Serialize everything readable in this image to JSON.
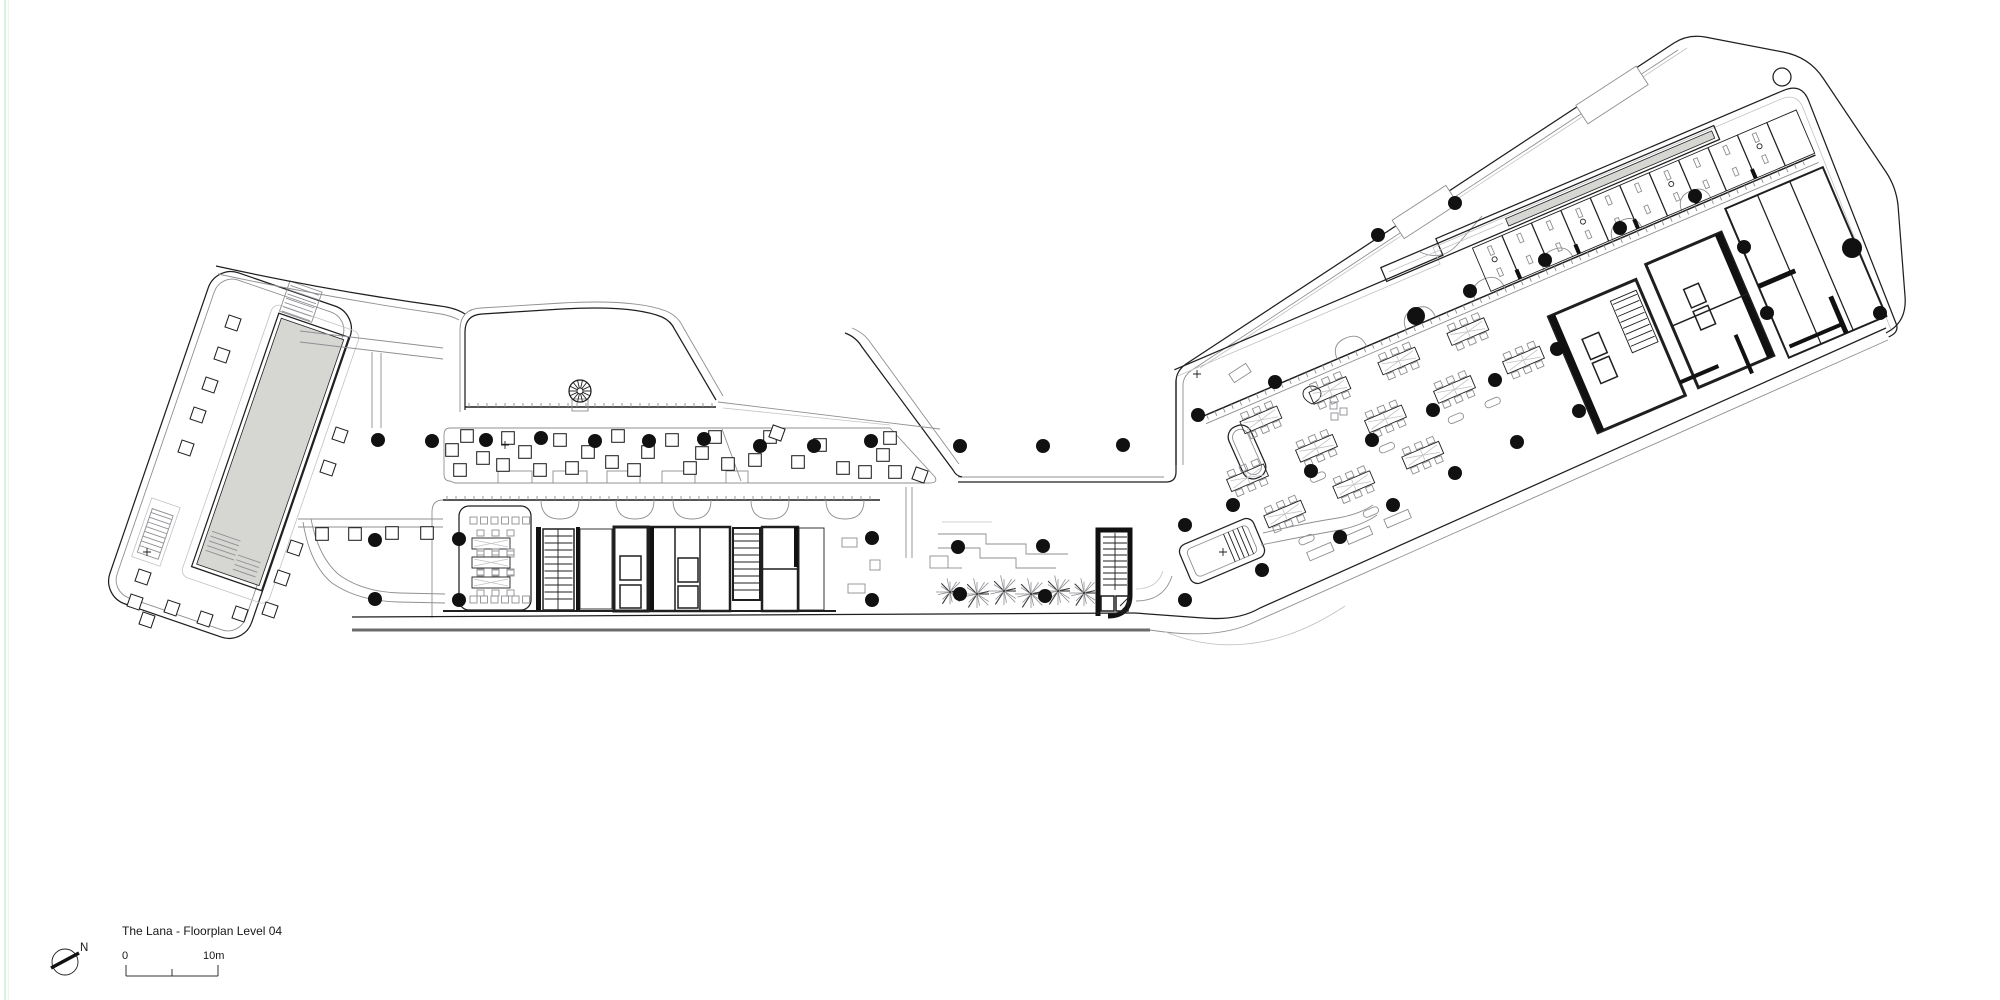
{
  "legend": {
    "title": "The Lana - Floorplan Level 04",
    "scale_zero": "0",
    "scale_end": "10m",
    "north_label": "N"
  },
  "colors": {
    "paper": "#ffffff",
    "ink": "#1f1f1f",
    "light": "#8f8f94",
    "faint": "#c2c2c6",
    "wall": "#111111",
    "pool": "#d6d6d2",
    "deck": "#6b6b6b",
    "sheet_edge": "#d4efd4"
  },
  "plan": {
    "columns": [
      [
        378,
        440
      ],
      [
        432,
        441
      ],
      [
        486,
        440
      ],
      [
        541,
        438
      ],
      [
        595,
        441
      ],
      [
        649,
        441
      ],
      [
        704,
        439
      ],
      [
        760,
        446
      ],
      [
        814,
        446
      ],
      [
        871,
        441
      ],
      [
        375,
        540
      ],
      [
        375,
        599
      ],
      [
        459,
        539
      ],
      [
        459,
        600
      ],
      [
        872,
        538
      ],
      [
        872,
        600
      ],
      [
        960,
        446
      ],
      [
        1043,
        446
      ],
      [
        1123,
        445
      ],
      [
        958,
        547
      ],
      [
        1043,
        546
      ],
      [
        960,
        594
      ],
      [
        1045,
        596
      ],
      [
        1198,
        415
      ],
      [
        1275,
        382
      ],
      [
        1233,
        505
      ],
      [
        1185,
        525
      ],
      [
        1262,
        570
      ],
      [
        1185,
        600
      ],
      [
        1340,
        537
      ],
      [
        1311,
        471
      ],
      [
        1378,
        235
      ],
      [
        1455,
        203
      ],
      [
        1416,
        316,
        9
      ],
      [
        1470,
        291
      ],
      [
        1545,
        260
      ],
      [
        1620,
        228
      ],
      [
        1695,
        196
      ],
      [
        1744,
        247
      ],
      [
        1372,
        440
      ],
      [
        1433,
        410
      ],
      [
        1495,
        380
      ],
      [
        1557,
        349
      ],
      [
        1393,
        505
      ],
      [
        1455,
        473
      ],
      [
        1517,
        442
      ],
      [
        1579,
        411
      ],
      [
        1852,
        248,
        10
      ],
      [
        1880,
        313
      ],
      [
        1767,
        313
      ]
    ],
    "planter_squares": [
      [
        233,
        323,
        19
      ],
      [
        222,
        355,
        19
      ],
      [
        210,
        385,
        19
      ],
      [
        198,
        415,
        19
      ],
      [
        186,
        448,
        19
      ],
      [
        143,
        577,
        19
      ],
      [
        135,
        602,
        19
      ],
      [
        147,
        620,
        19
      ],
      [
        172,
        608,
        19
      ],
      [
        205,
        619,
        19
      ],
      [
        240,
        614,
        19
      ],
      [
        270,
        610,
        19
      ],
      [
        282,
        578,
        19
      ],
      [
        295,
        548,
        19
      ],
      [
        328,
        468,
        19
      ],
      [
        340,
        435,
        19
      ],
      [
        322,
        534,
        0
      ],
      [
        355,
        534,
        0
      ],
      [
        392,
        533,
        0
      ],
      [
        427,
        533,
        0
      ],
      [
        452,
        450,
        0
      ],
      [
        467,
        436,
        0
      ],
      [
        460,
        470,
        0
      ],
      [
        483,
        458,
        0
      ],
      [
        508,
        438,
        0
      ],
      [
        503,
        465,
        0
      ],
      [
        525,
        452,
        0
      ],
      [
        540,
        470,
        0
      ],
      [
        560,
        440,
        0
      ],
      [
        572,
        468,
        0
      ],
      [
        588,
        452,
        0
      ],
      [
        618,
        436,
        0
      ],
      [
        612,
        462,
        0
      ],
      [
        634,
        470,
        0
      ],
      [
        648,
        452,
        0
      ],
      [
        672,
        440,
        0
      ],
      [
        690,
        468,
        0
      ],
      [
        702,
        453,
        0
      ],
      [
        715,
        437,
        0
      ],
      [
        728,
        464,
        0
      ],
      [
        755,
        460,
        0
      ],
      [
        770,
        437,
        0
      ],
      [
        777,
        433,
        20
      ],
      [
        798,
        462,
        0
      ],
      [
        820,
        445,
        0
      ],
      [
        843,
        468,
        0
      ],
      [
        890,
        438,
        0
      ],
      [
        883,
        455,
        0
      ],
      [
        865,
        472,
        0
      ],
      [
        895,
        472,
        0
      ],
      [
        920,
        475,
        20
      ]
    ],
    "palms": [
      [
        950,
        592,
        14
      ],
      [
        977,
        594,
        16
      ],
      [
        1004,
        591,
        16
      ],
      [
        1031,
        594,
        16
      ],
      [
        1058,
        591,
        16
      ],
      [
        1084,
        593,
        15
      ]
    ],
    "survey_marks": [
      [
        505,
        445
      ],
      [
        147,
        552
      ],
      [
        1197,
        374
      ],
      [
        1223,
        552
      ]
    ]
  }
}
